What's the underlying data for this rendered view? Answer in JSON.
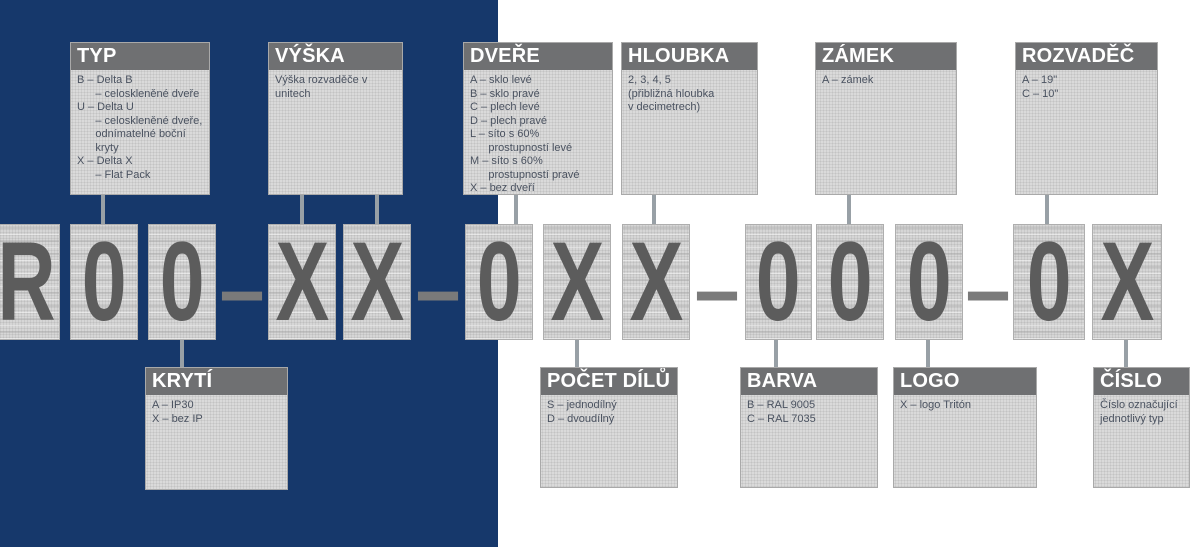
{
  "colors": {
    "panel_blue": "#16386B",
    "header_gray": "#6F7072",
    "box_fill": "#DADADA",
    "glyph_gray": "#5C5C5C",
    "connector_gray": "#98A0A6",
    "body_text": "#4A5260"
  },
  "code": {
    "cells": [
      "R",
      "0",
      "0",
      "X",
      "X",
      "0",
      "X",
      "X",
      "0",
      "0",
      "0",
      "0",
      "X"
    ],
    "separator": "–",
    "full_code": "R00–XX–0XX–000–0X"
  },
  "legend_top": {
    "typ": {
      "title": "TYP",
      "body": "B – Delta B\n      – celoskleněné dveře\nU – Delta U\n      – celoskleněné dveře,\n      odnímatelné boční\n      kryty\nX – Delta X\n      – Flat Pack"
    },
    "vyska": {
      "title": "VÝŠKA",
      "body": "Výška rozvaděče v unitech"
    },
    "dvere": {
      "title": "DVEŘE",
      "body": "A – sklo levé\nB – sklo pravé\nC – plech levé\nD – plech pravé\nL – síto s 60%\n      prostupností levé\nM – síto s 60%\n      prostupností pravé\nX – bez dveří"
    },
    "hloubka": {
      "title": "HLOUBKA",
      "body": "2, 3, 4, 5\n(přibližná hloubka\nv decimetrech)"
    },
    "zamek": {
      "title": "ZÁMEK",
      "body": "A – zámek"
    },
    "rozvadec": {
      "title": "ROZVADĚČ",
      "body": "A – 19\"\nC – 10\""
    }
  },
  "legend_bottom": {
    "kryti": {
      "title": "KRYTÍ",
      "body": "A – IP30\nX – bez IP"
    },
    "pocet_dilu": {
      "title": "POČET DÍLŮ",
      "body": "S – jednodílný\nD – dvoudílný"
    },
    "barva": {
      "title": "BARVA",
      "body": "B – RAL 9005\nC – RAL 7035"
    },
    "logo": {
      "title": "LOGO",
      "body": "X – logo Tritón"
    },
    "cislo": {
      "title": "ČÍSLO",
      "body": "Číslo označující\njednotlivý typ"
    }
  }
}
